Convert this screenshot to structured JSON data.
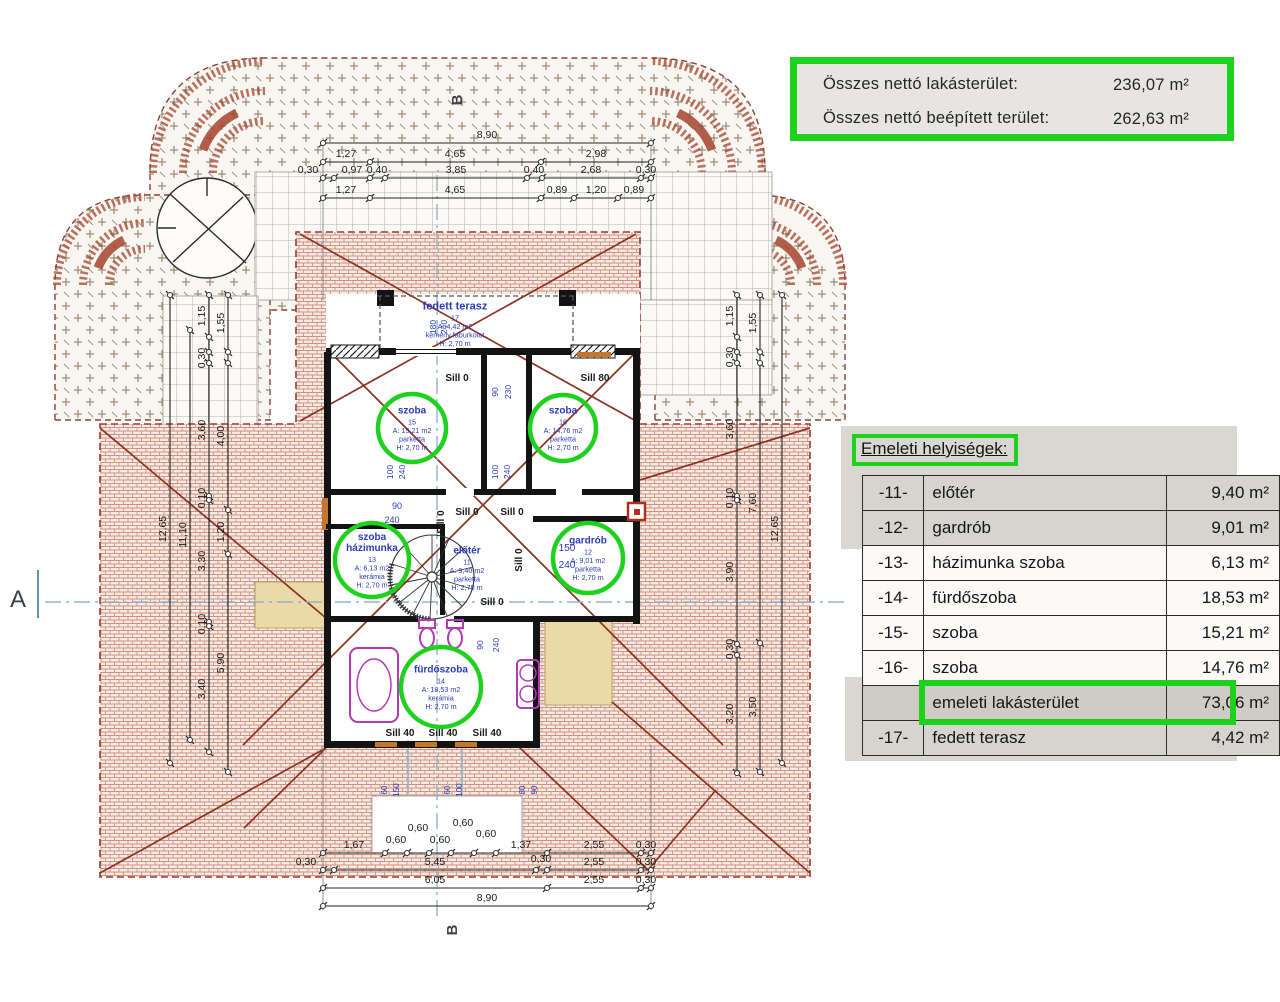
{
  "colors": {
    "green": "#1dd11d",
    "blue": "#2a3ab8",
    "black": "#1a1a1a",
    "marker": "#3c4248",
    "ridge": "#8e3120",
    "magenta": "#b43ab4",
    "orange": "#c4762a",
    "axis_blue": "#8fb6c9"
  },
  "summary_box": {
    "rows": [
      {
        "label": "Összes nettó lakásterület:",
        "value": "236,07 m²"
      },
      {
        "label": "Összes nettó beépített terület:",
        "value": "262,63 m²"
      }
    ]
  },
  "floor_table": {
    "title": "Emeleti helyiségek:",
    "rows": [
      {
        "num": "-11-",
        "name": "előtér",
        "area": "9,40 m²",
        "style": "shade"
      },
      {
        "num": "-12-",
        "name": "gardrób",
        "area": "9,01 m²",
        "style": "shade"
      },
      {
        "num": "-13-",
        "name": "házimunka  szoba",
        "area": "6,13 m²",
        "style": "plain"
      },
      {
        "num": "-14-",
        "name": "fürdőszoba",
        "area": "18,53 m²",
        "style": "plain"
      },
      {
        "num": "-15-",
        "name": "szoba",
        "area": "15,21 m²",
        "style": "plain"
      },
      {
        "num": "-16-",
        "name": "szoba",
        "area": "14,76 m²",
        "style": "plain"
      },
      {
        "num": "",
        "name": "emeleti lakásterület",
        "area": "73,06 m²",
        "style": "hl"
      },
      {
        "num": "-17-",
        "name": "fedett terasz",
        "area": "4,42 m²",
        "style": "shade"
      }
    ]
  },
  "rooms": [
    {
      "lines": [
        "szoba",
        "15",
        "A: 15,21 m2",
        "parketta",
        "H: 2,70 m"
      ],
      "cx": 412,
      "cy": 428,
      "r": 34,
      "nb": 1,
      "circ": true
    },
    {
      "lines": [
        "szoba",
        "16",
        "A: 14,76 m2",
        "parketta",
        "H: 2,70 m"
      ],
      "cx": 563,
      "cy": 428,
      "r": 33,
      "nb": 1,
      "circ": true
    },
    {
      "lines": [
        "szoba",
        "házimunka",
        "13",
        "A: 6,13 m2",
        "kerámia",
        "H: 2,70 m"
      ],
      "cx": 372,
      "cy": 560,
      "r": 37,
      "nb": 2,
      "circ": true
    },
    {
      "lines": [
        "előtér",
        "11",
        "A: 9,40 m2",
        "parketta",
        "H: 2,70 m"
      ],
      "cx": 467,
      "cy": 568,
      "nb": 1,
      "circ": false
    },
    {
      "lines": [
        "gardrób",
        "12",
        "A: 9,01 m2",
        "parketta",
        "H: 2,70 m"
      ],
      "cx": 588,
      "cy": 558,
      "r": 35,
      "nb": 1,
      "circ": true
    },
    {
      "lines": [
        "fürdőszoba",
        "14",
        "A: 18,53 m2",
        "kerámia",
        "H: 2,70 m"
      ],
      "cx": 441,
      "cy": 687,
      "r": 40,
      "nb": 1,
      "circ": true
    },
    {
      "lines": [
        "fedett terasz",
        "17",
        "A: 4,42 m2",
        "kemény faburkolat",
        "H: 2,70 m"
      ],
      "cx": 455,
      "cy": 324,
      "nb": 1,
      "circ": false,
      "fs": 11
    }
  ],
  "h_dims": [
    {
      "y": 143,
      "nodes": [
        323,
        651
      ],
      "labels": [
        {
          "t": "8,90",
          "x": 487
        }
      ]
    },
    {
      "y": 162,
      "nodes": [
        323,
        370,
        541,
        651
      ],
      "labels": [
        {
          "t": "1,27",
          "x": 346
        },
        {
          "t": "4,65",
          "x": 455
        },
        {
          "t": "2,98",
          "x": 596
        }
      ]
    },
    {
      "y": 178,
      "nodes": [
        323,
        334,
        370,
        385,
        527,
        542,
        641,
        651
      ],
      "labels": [
        {
          "t": "0,30",
          "x": 308
        },
        {
          "t": "0,97",
          "x": 352
        },
        {
          "t": "0,40",
          "x": 377
        },
        {
          "t": "3,85",
          "x": 456
        },
        {
          "t": "0,40",
          "x": 534
        },
        {
          "t": "2,68",
          "x": 591
        },
        {
          "t": "0,30",
          "x": 646
        }
      ]
    },
    {
      "y": 198,
      "nodes": [
        323,
        370,
        541,
        574,
        618,
        651
      ],
      "labels": [
        {
          "t": "1,27",
          "x": 346
        },
        {
          "t": "4,65",
          "x": 455
        },
        {
          "t": "0,89",
          "x": 557
        },
        {
          "t": "1,20",
          "x": 596
        },
        {
          "t": "0,89",
          "x": 634
        }
      ]
    },
    {
      "y": 853,
      "nodes": [
        323,
        385,
        407,
        429,
        451,
        474,
        496,
        547,
        641,
        651
      ],
      "labels": [
        {
          "t": "1,67",
          "x": 354
        },
        {
          "t": "0,60",
          "x": 396,
          "ly": 843
        },
        {
          "t": "0,60",
          "x": 418,
          "ly": 831
        },
        {
          "t": "0,60",
          "x": 440,
          "ly": 843
        },
        {
          "t": "0,60",
          "x": 463,
          "ly": 826
        },
        {
          "t": "0,60",
          "x": 486,
          "ly": 837
        },
        {
          "t": "1,37",
          "x": 521
        },
        {
          "t": "2,55",
          "x": 594
        },
        {
          "t": "0,30",
          "x": 646
        }
      ]
    },
    {
      "y": 870,
      "nodes": [
        323,
        334,
        536,
        547,
        641,
        651
      ],
      "labels": [
        {
          "t": "0,30",
          "x": 306
        },
        {
          "t": "5,45",
          "x": 435
        },
        {
          "t": "0,30",
          "x": 541,
          "ly": 862
        },
        {
          "t": "2,55",
          "x": 594
        },
        {
          "t": "0,30",
          "x": 646
        }
      ]
    },
    {
      "y": 888,
      "nodes": [
        323,
        547,
        641,
        651
      ],
      "labels": [
        {
          "t": "6,05",
          "x": 435
        },
        {
          "t": "2,55",
          "x": 594
        },
        {
          "t": "0,30",
          "x": 646
        }
      ]
    },
    {
      "y": 906,
      "nodes": [
        323,
        651
      ],
      "labels": [
        {
          "t": "8,90",
          "x": 487
        }
      ]
    }
  ],
  "v_dims": [
    {
      "x": 170,
      "nodes": [
        295,
        763
      ],
      "labels": [
        {
          "t": "12,65",
          "y": 529
        }
      ]
    },
    {
      "x": 190,
      "nodes": [
        330,
        740
      ],
      "labels": [
        {
          "t": "11,10",
          "y": 535
        }
      ]
    },
    {
      "x": 209,
      "nodes": [
        295,
        337,
        352,
        363,
        496,
        500,
        622,
        626,
        752
      ],
      "labels": [
        {
          "t": "1,15",
          "y": 316
        },
        {
          "t": "0,30",
          "y": 358
        },
        {
          "t": "3,60",
          "y": 430
        },
        {
          "t": "0,10",
          "y": 498
        },
        {
          "t": "3,30",
          "y": 561
        },
        {
          "t": "0,10",
          "y": 624
        },
        {
          "t": "3,40",
          "y": 689
        }
      ]
    },
    {
      "x": 228,
      "nodes": [
        295,
        352,
        363,
        510,
        554,
        772
      ],
      "labels": [
        {
          "t": "1,55",
          "y": 323
        },
        {
          "t": "4,00",
          "y": 436
        },
        {
          "t": "1,20",
          "y": 532
        },
        {
          "t": "5,90",
          "y": 663
        }
      ]
    },
    {
      "x": 737,
      "nodes": [
        295,
        337,
        352,
        363,
        496,
        500,
        644,
        655,
        773
      ],
      "labels": [
        {
          "t": "1,15",
          "y": 316
        },
        {
          "t": "0,30",
          "y": 357
        },
        {
          "t": "3,60",
          "y": 429
        },
        {
          "t": "0,10",
          "y": 498
        },
        {
          "t": "3,90",
          "y": 572
        },
        {
          "t": "0,30",
          "y": 649
        },
        {
          "t": "3,20",
          "y": 714
        }
      ]
    },
    {
      "x": 760,
      "nodes": [
        295,
        352,
        363,
        643,
        772
      ],
      "labels": [
        {
          "t": "1,55",
          "y": 323
        },
        {
          "t": "7,60",
          "y": 503
        },
        {
          "t": "3,50",
          "y": 707
        }
      ]
    },
    {
      "x": 782,
      "nodes": [
        295,
        763
      ],
      "labels": [
        {
          "t": "12,65",
          "y": 529
        }
      ]
    }
  ],
  "texts": [
    {
      "t": "Sill 0",
      "x": 457,
      "y": 381,
      "b": 600
    },
    {
      "t": "Sill 80",
      "x": 595,
      "y": 381,
      "b": 600
    },
    {
      "t": "Sill 0",
      "x": 467,
      "y": 515,
      "b": 600
    },
    {
      "t": "Sill 0",
      "x": 512,
      "y": 515,
      "b": 600
    },
    {
      "t": "Sill 0",
      "x": 444,
      "y": 522,
      "b": 600,
      "r": -90
    },
    {
      "t": "Sill 0",
      "x": 522,
      "y": 560,
      "b": 600,
      "r": -90
    },
    {
      "t": "Sill 0",
      "x": 492,
      "y": 605,
      "b": 600
    },
    {
      "t": "Sill 40",
      "x": 400,
      "y": 736,
      "b": 700
    },
    {
      "t": "Sill 40",
      "x": 443,
      "y": 736,
      "b": 700
    },
    {
      "t": "Sill 40",
      "x": 487,
      "y": 736,
      "b": 700
    },
    {
      "t": "180",
      "x": 436,
      "y": 327,
      "s": 8.5,
      "c": "b",
      "r": -90
    },
    {
      "t": "240",
      "x": 447,
      "y": 327,
      "s": 8.5,
      "c": "b",
      "r": -90
    },
    {
      "t": "90",
      "x": 498,
      "y": 392,
      "s": 8.5,
      "c": "b",
      "r": -90
    },
    {
      "t": "230",
      "x": 511,
      "y": 392,
      "s": 8.5,
      "c": "b",
      "r": -90
    },
    {
      "t": "100",
      "x": 393,
      "y": 472,
      "s": 8.5,
      "c": "b",
      "r": -90
    },
    {
      "t": "240",
      "x": 405,
      "y": 472,
      "s": 8.5,
      "c": "b",
      "r": -90
    },
    {
      "t": "100",
      "x": 498,
      "y": 472,
      "s": 8.5,
      "c": "b",
      "r": -90
    },
    {
      "t": "240",
      "x": 510,
      "y": 472,
      "s": 8.5,
      "c": "b",
      "r": -90
    },
    {
      "t": "90",
      "x": 397,
      "y": 509,
      "s": 9,
      "c": "b"
    },
    {
      "t": "240",
      "x": 392,
      "y": 523,
      "s": 9,
      "c": "b"
    },
    {
      "t": "150",
      "x": 567,
      "y": 551,
      "s": 10,
      "c": "b"
    },
    {
      "t": "240",
      "x": 567,
      "y": 568,
      "s": 10,
      "c": "b"
    },
    {
      "t": "90",
      "x": 483,
      "y": 645,
      "s": 8.5,
      "c": "b",
      "r": -90
    },
    {
      "t": "240",
      "x": 499,
      "y": 645,
      "s": 8.5,
      "c": "b",
      "r": -90
    },
    {
      "t": "60",
      "x": 387,
      "y": 790,
      "s": 8,
      "c": "b",
      "r": -90
    },
    {
      "t": "150",
      "x": 399,
      "y": 790,
      "s": 8,
      "c": "b",
      "r": -90
    },
    {
      "t": "60",
      "x": 450,
      "y": 790,
      "s": 8,
      "c": "b",
      "r": -90
    },
    {
      "t": "100",
      "x": 462,
      "y": 790,
      "s": 8,
      "c": "b",
      "r": -90
    },
    {
      "t": "80",
      "x": 525,
      "y": 790,
      "s": 8,
      "c": "b",
      "r": -90
    },
    {
      "t": "90",
      "x": 537,
      "y": 790,
      "s": 8,
      "c": "b",
      "r": -90
    },
    {
      "t": "A",
      "x": 18,
      "y": 607,
      "s": 24,
      "c": "d"
    },
    {
      "t": "B",
      "x": 462,
      "y": 100,
      "s": 15,
      "c": "d",
      "r": -90,
      "b": 600
    },
    {
      "t": "B",
      "x": 457,
      "y": 930,
      "s": 15,
      "c": "d",
      "r": -90,
      "b": 600
    }
  ]
}
